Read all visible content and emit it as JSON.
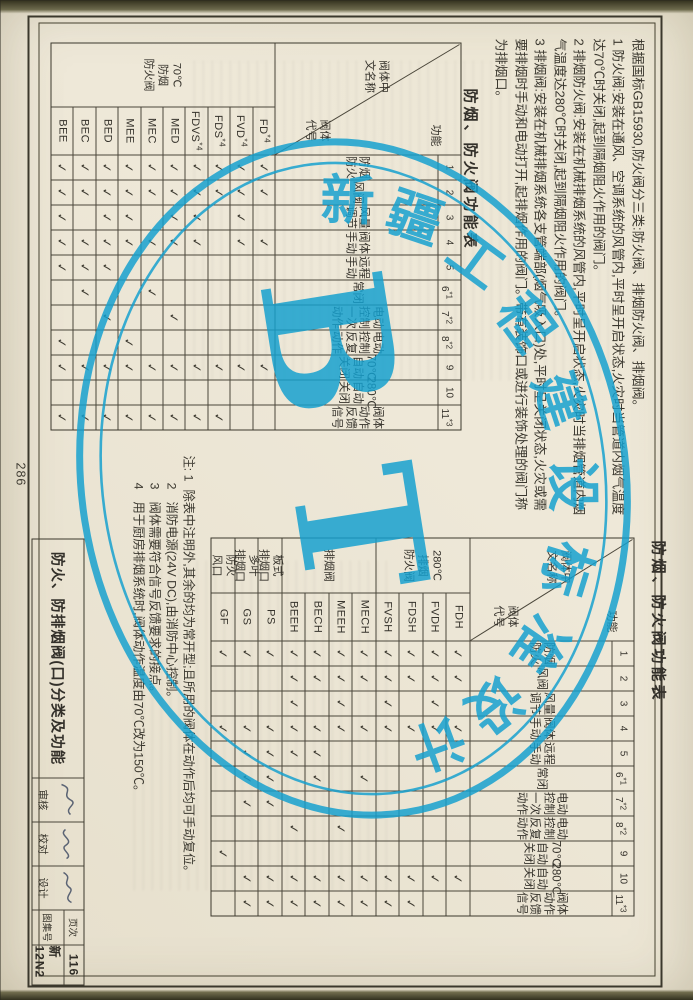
{
  "page": {
    "number": "286"
  },
  "stamp": {
    "arc_text": "新疆工程建设标准设计",
    "center_text": "BT",
    "color": "#13a0cf"
  },
  "intro_notes": {
    "lines": [
      "根据国标GB15930,防火阀分三类:防火阀、排烟防火阀、排烟阀。",
      "1  防火阀:安装在通风、空调系统的风管内,平时呈开启状态,火灾时当管道内烟气温度",
      "   达70℃时关闭,起到隔烟阻火作用的阀门。",
      "2  排烟防火阀:安装在机械排烟系统的风管内,平时呈开启状态,火灾时当排烟管道内烟",
      "   气温度达280℃时关闭,起到隔烟阻火作用的阀门。",
      "3  排烟阀:安装在机械排烟系统各支管端部(烟气吸入口)处,平时呈关闭状态,火灾或需",
      "   要排烟时手动和电动打开,起排烟作用的阀门。带有装饰口或进行装饰处理的阀门称",
      "   为排烟口。"
    ]
  },
  "function_header": {
    "corner_fn": "功能",
    "corner_name": "阀体中/文名称",
    "corner_code": "阀体/代号",
    "numbers": [
      "1",
      "2",
      "3",
      "4",
      "5",
      "6*1",
      "7*2",
      "8*2",
      "9",
      "10",
      "11*3"
    ],
    "names": [
      "防烟/防火",
      "风阀",
      "风量/调节",
      "阀体/手动",
      "远程/手动",
      "常闭",
      "电动/控制/一次/动作",
      "电动/控制/反复/动作",
      "70℃/自动/关闭",
      "280℃/自动/关闭",
      "阀体/动作/反馈/信号"
    ]
  },
  "table1": {
    "title": "防烟、防火阀功能表",
    "groups": [
      {
        "name": "70℃/防烟/防火阀",
        "span": 10
      }
    ],
    "rows": [
      {
        "code": "FD",
        "sup": "*4",
        "checks": [
          1,
          1,
          0,
          1,
          0,
          0,
          0,
          0,
          1,
          0,
          0
        ]
      },
      {
        "code": "FVD",
        "sup": "*4",
        "checks": [
          1,
          1,
          1,
          1,
          0,
          0,
          0,
          0,
          1,
          0,
          0
        ]
      },
      {
        "code": "FDS",
        "sup": "*4",
        "checks": [
          1,
          1,
          0,
          0,
          0,
          0,
          0,
          0,
          1,
          0,
          1
        ]
      },
      {
        "code": "FDVS",
        "sup": "*4",
        "checks": [
          1,
          1,
          1,
          1,
          0,
          0,
          0,
          0,
          1,
          0,
          1
        ]
      },
      {
        "code": "MED",
        "sup": "",
        "checks": [
          1,
          1,
          1,
          1,
          0,
          0,
          1,
          0,
          1,
          0,
          1
        ]
      },
      {
        "code": "MEC",
        "sup": "",
        "checks": [
          1,
          1,
          0,
          1,
          0,
          1,
          0,
          0,
          1,
          0,
          1
        ]
      },
      {
        "code": "MEE",
        "sup": "",
        "checks": [
          1,
          1,
          1,
          1,
          0,
          0,
          0,
          1,
          1,
          0,
          1
        ]
      },
      {
        "code": "BED",
        "sup": "",
        "checks": [
          1,
          1,
          1,
          1,
          1,
          0,
          1,
          0,
          1,
          0,
          1
        ]
      },
      {
        "code": "BEC",
        "sup": "",
        "checks": [
          1,
          1,
          0,
          1,
          1,
          1,
          0,
          0,
          1,
          0,
          1
        ]
      },
      {
        "code": "BEE",
        "sup": "",
        "checks": [
          1,
          1,
          1,
          1,
          1,
          0,
          0,
          1,
          1,
          0,
          1
        ]
      }
    ]
  },
  "table2": {
    "title": "防烟、防火阀功能表",
    "groups": [
      {
        "name": "280℃/排烟/防火阀",
        "span": 4
      },
      {
        "name": "排烟阀",
        "span": 4
      },
      {
        "name": "板式/排烟口",
        "span": 1
      },
      {
        "name": "多叶/排烟口",
        "span": 1
      },
      {
        "name": "防火/风口",
        "span": 1
      }
    ],
    "rows": [
      {
        "code": "FDH",
        "sup": "",
        "checks": [
          1,
          1,
          0,
          1,
          0,
          0,
          0,
          0,
          0,
          1,
          0
        ]
      },
      {
        "code": "FVDH",
        "sup": "",
        "checks": [
          1,
          1,
          1,
          1,
          0,
          0,
          0,
          0,
          0,
          1,
          0
        ]
      },
      {
        "code": "FDSH",
        "sup": "",
        "checks": [
          1,
          1,
          0,
          1,
          0,
          0,
          0,
          0,
          0,
          1,
          1
        ]
      },
      {
        "code": "FVSH",
        "sup": "",
        "checks": [
          1,
          1,
          1,
          1,
          0,
          0,
          0,
          0,
          0,
          1,
          1
        ]
      },
      {
        "code": "MECH",
        "sup": "",
        "checks": [
          1,
          1,
          0,
          1,
          0,
          1,
          0,
          0,
          0,
          1,
          1
        ]
      },
      {
        "code": "MEEH",
        "sup": "",
        "checks": [
          1,
          1,
          1,
          1,
          0,
          0,
          0,
          1,
          0,
          1,
          1
        ]
      },
      {
        "code": "BECH",
        "sup": "",
        "checks": [
          1,
          1,
          0,
          1,
          1,
          1,
          0,
          0,
          0,
          1,
          1
        ]
      },
      {
        "code": "BEEH",
        "sup": "",
        "checks": [
          1,
          1,
          1,
          1,
          1,
          0,
          0,
          1,
          0,
          1,
          1
        ]
      },
      {
        "code": "PS",
        "sup": "",
        "checks": [
          1,
          0,
          0,
          1,
          1,
          1,
          1,
          0,
          0,
          1,
          1
        ]
      },
      {
        "code": "GS",
        "sup": "",
        "checks": [
          1,
          0,
          0,
          1,
          1,
          1,
          1,
          0,
          0,
          1,
          1
        ]
      },
      {
        "code": "GF",
        "sup": "",
        "checks": [
          1,
          0,
          0,
          1,
          0,
          0,
          0,
          0,
          1,
          0,
          0
        ]
      }
    ]
  },
  "bottom_notes": {
    "lines": [
      {
        "mark": "注: 1",
        "text": "除表中注明外,其余的均为常开型;且所用的阀体在动作后均可手动复位。"
      },
      {
        "mark": "2",
        "text": "消防电源(24V DC),由消防中心控制。"
      },
      {
        "mark": "3",
        "text": "阀体需要符合信号反馈要求的接点。"
      },
      {
        "mark": "4",
        "text": "用于厨房排烟系统时,阀体动作温度由70℃改为150℃。"
      }
    ]
  },
  "title_block": {
    "title": "防火、防排烟阀(口)分类及功能",
    "sign_fields": [
      {
        "label": "审核"
      },
      {
        "label": "校对"
      },
      {
        "label": "设计"
      }
    ],
    "page_label": "页次",
    "page_no": "116",
    "atlas_label": "图集号",
    "atlas_no": "新12N2"
  }
}
